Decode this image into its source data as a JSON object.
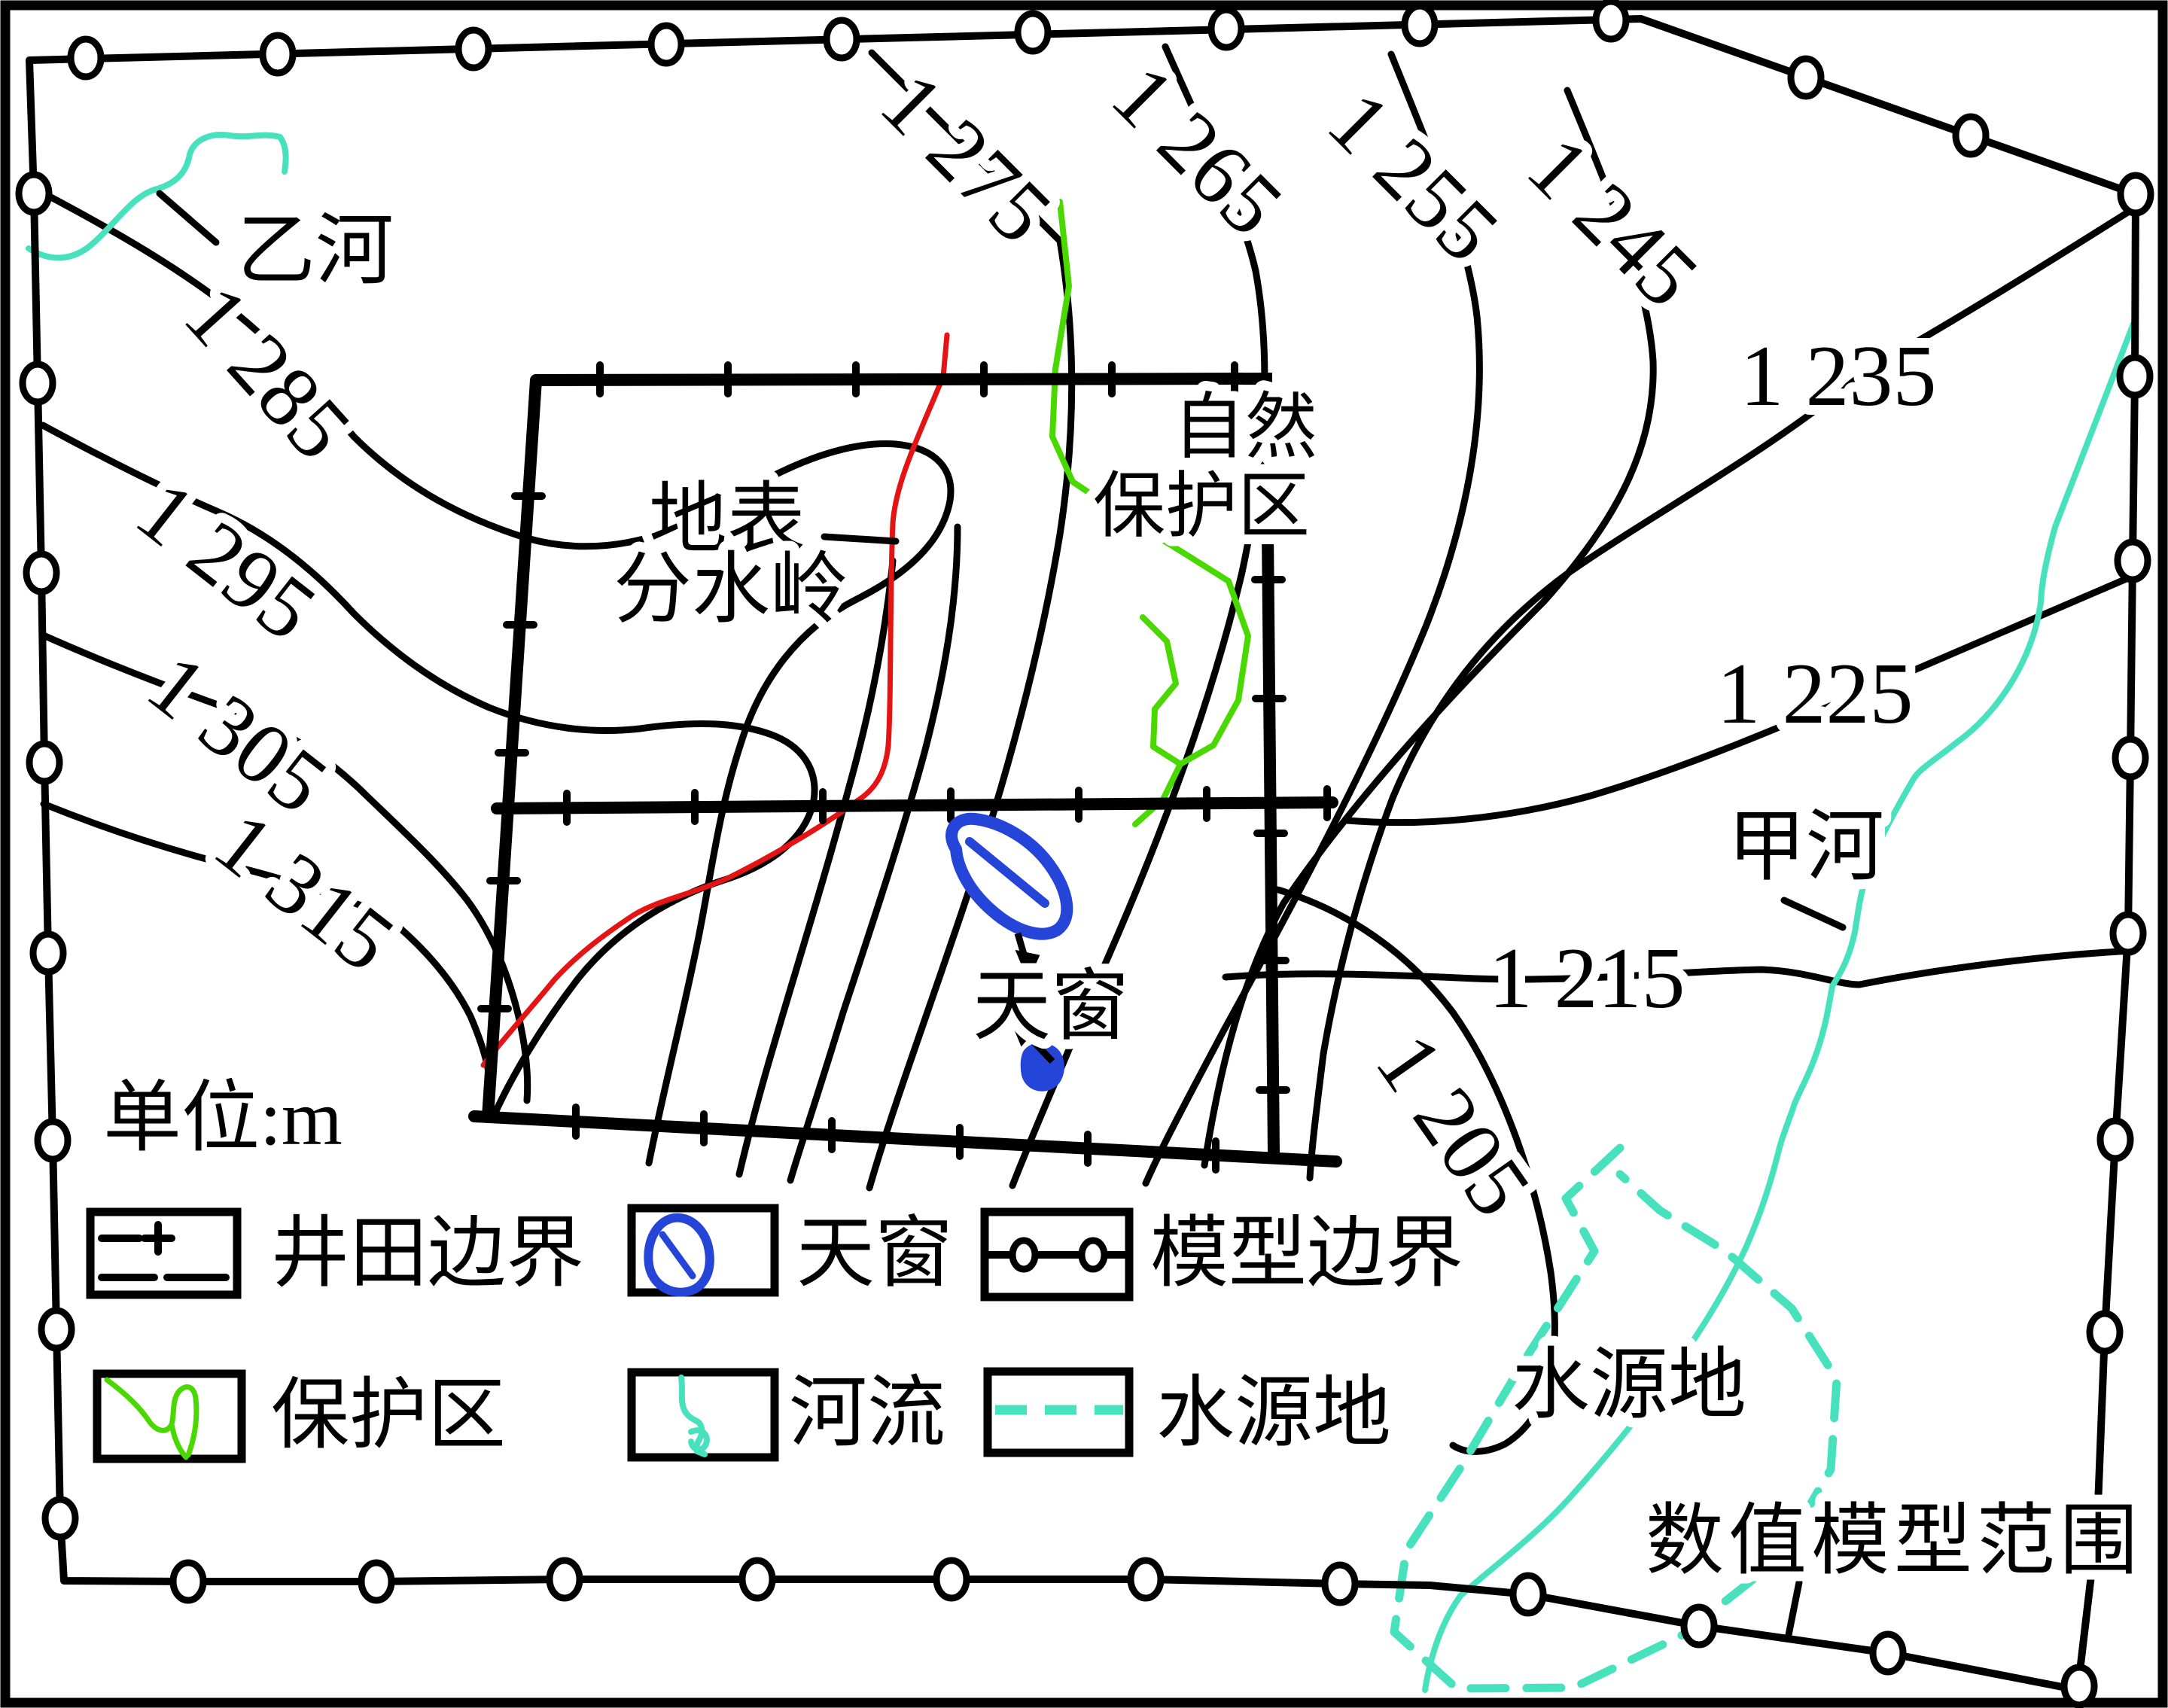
{
  "figure": {
    "unit_label": "单位:m",
    "model_extent_label": "数值模型范围"
  },
  "colors": {
    "contour": "#000000",
    "river": "#47e2bd",
    "reserve": "#49d800",
    "skylight": "#2544d8",
    "watershed": "#e51414",
    "background": "#ffffff"
  },
  "contour_labels": [
    {
      "text": "1 275"
    },
    {
      "text": "1 265"
    },
    {
      "text": "1 255"
    },
    {
      "text": "1 245"
    },
    {
      "text": "1 235"
    },
    {
      "text": "1 225"
    },
    {
      "text": "1 215"
    },
    {
      "text": "1 205"
    },
    {
      "text": "1 285"
    },
    {
      "text": "1 295"
    },
    {
      "text": "1 305"
    },
    {
      "text": "1 315"
    }
  ],
  "contour_values_m": [
    1205,
    1215,
    1225,
    1235,
    1245,
    1255,
    1265,
    1275,
    1285,
    1295,
    1305,
    1315
  ],
  "map_labels": {
    "river_yi": "乙河",
    "river_jia": "甲河",
    "watershed_line1": "地表",
    "watershed_line2": "分水岭",
    "reserve_line1": "自然",
    "reserve_line2": "保护区",
    "skylight": "天窗",
    "water_source": "水源地"
  },
  "legend": {
    "items": [
      {
        "label": "井田边界"
      },
      {
        "label": "天窗"
      },
      {
        "label": "模型边界"
      },
      {
        "label": "保护区"
      },
      {
        "label": "河流"
      },
      {
        "label": "水源地"
      }
    ]
  }
}
